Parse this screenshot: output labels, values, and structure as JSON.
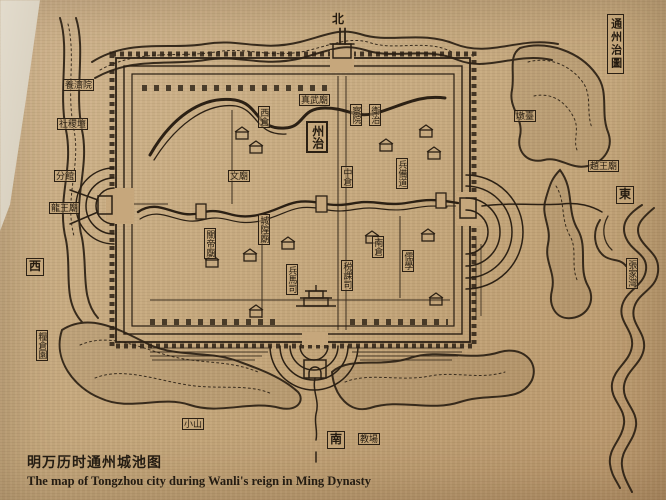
{
  "photo": {
    "caption_cn": "明万历时通州城池图",
    "caption_en": "The map of Tongzhou city during Wanli's reign in Ming Dynasty"
  },
  "colors": {
    "parchment": "#c6a77c",
    "ink": "#2b2014",
    "wall_edge": "#ddd4c5"
  },
  "map": {
    "labels": [
      {
        "id": "compass-north",
        "text": "北",
        "x": 330,
        "y": 12,
        "vertical": false,
        "boxed": false,
        "compass": true
      },
      {
        "id": "title-cartouche",
        "text": "通州治圖",
        "x": 607,
        "y": 14,
        "vertical": true,
        "boxed": true,
        "cartouche": true
      },
      {
        "id": "compass-east",
        "text": "東",
        "x": 616,
        "y": 186,
        "vertical": false,
        "boxed": true,
        "compass": true
      },
      {
        "id": "compass-west",
        "text": "西",
        "x": 26,
        "y": 258,
        "vertical": false,
        "boxed": true,
        "compass": true
      },
      {
        "id": "compass-south",
        "text": "南",
        "x": 327,
        "y": 431,
        "vertical": false,
        "boxed": true,
        "compass": true
      },
      {
        "id": "jiaochang",
        "text": "教場",
        "x": 358,
        "y": 433,
        "vertical": false,
        "boxed": true
      },
      {
        "id": "yangjiyuan",
        "text": "養濟院",
        "x": 63,
        "y": 79,
        "vertical": false,
        "boxed": true
      },
      {
        "id": "shejitan",
        "text": "社稷壇",
        "x": 57,
        "y": 118,
        "vertical": false,
        "boxed": true
      },
      {
        "id": "fenguan",
        "text": "分館",
        "x": 54,
        "y": 170,
        "vertical": false,
        "boxed": true
      },
      {
        "id": "longwangmiao",
        "text": "龍王廟",
        "x": 49,
        "y": 202,
        "vertical": false,
        "boxed": true
      },
      {
        "id": "liangcangyuan",
        "text": "糧倉園",
        "x": 36,
        "y": 330,
        "vertical": true,
        "boxed": true
      },
      {
        "id": "xiaoshan",
        "text": "小山",
        "x": 182,
        "y": 418,
        "vertical": false,
        "boxed": true
      },
      {
        "id": "zhenwumiao",
        "text": "真武廟",
        "x": 299,
        "y": 94,
        "vertical": false,
        "boxed": true
      },
      {
        "id": "zhouzhi",
        "text": "州治",
        "x": 306,
        "y": 121,
        "vertical": true,
        "boxed": true,
        "big": true
      },
      {
        "id": "chayuan",
        "text": "察院",
        "x": 350,
        "y": 104,
        "vertical": true,
        "boxed": true
      },
      {
        "id": "weizhi",
        "text": "衛治",
        "x": 369,
        "y": 104,
        "vertical": true,
        "boxed": true
      },
      {
        "id": "xicang",
        "text": "西倉",
        "x": 258,
        "y": 106,
        "vertical": true,
        "boxed": true
      },
      {
        "id": "zhongcang",
        "text": "中倉",
        "x": 341,
        "y": 166,
        "vertical": true,
        "boxed": true
      },
      {
        "id": "bingbeidao",
        "text": "兵備道",
        "x": 396,
        "y": 158,
        "vertical": true,
        "boxed": true
      },
      {
        "id": "nancang",
        "text": "南倉",
        "x": 372,
        "y": 236,
        "vertical": true,
        "boxed": true
      },
      {
        "id": "ruxue",
        "text": "儒學",
        "x": 402,
        "y": 250,
        "vertical": true,
        "boxed": true
      },
      {
        "id": "wenmiao",
        "text": "文廟",
        "x": 228,
        "y": 170,
        "vertical": false,
        "boxed": true
      },
      {
        "id": "chenghuangmiao",
        "text": "城隍廟",
        "x": 258,
        "y": 214,
        "vertical": true,
        "boxed": true
      },
      {
        "id": "guandimiao",
        "text": "關帝廟",
        "x": 204,
        "y": 228,
        "vertical": true,
        "boxed": true
      },
      {
        "id": "bingmasi",
        "text": "兵馬司",
        "x": 286,
        "y": 264,
        "vertical": true,
        "boxed": true
      },
      {
        "id": "shuikesi",
        "text": "税課司",
        "x": 341,
        "y": 260,
        "vertical": true,
        "boxed": true
      },
      {
        "id": "duntai",
        "text": "墩臺",
        "x": 514,
        "y": 110,
        "vertical": false,
        "boxed": true
      },
      {
        "id": "zhaowangmiao",
        "text": "趙王廟",
        "x": 588,
        "y": 160,
        "vertical": false,
        "boxed": true
      },
      {
        "id": "zhangjiawan",
        "text": "張家灣",
        "x": 626,
        "y": 258,
        "vertical": true,
        "boxed": true
      }
    ]
  }
}
